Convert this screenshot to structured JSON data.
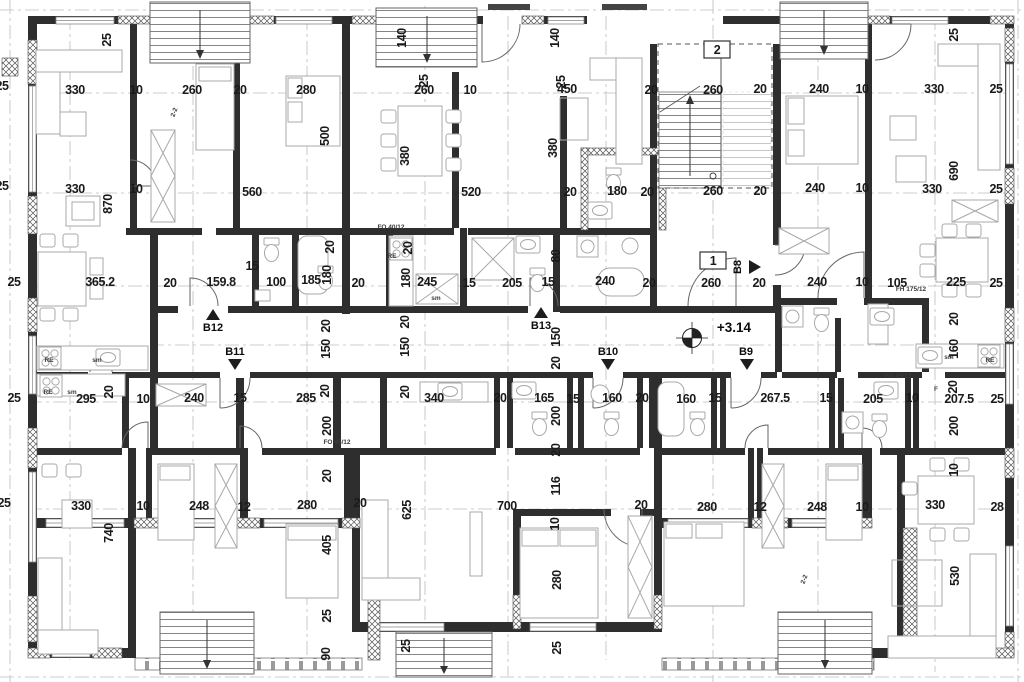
{
  "colors": {
    "wall": "#2e2e2e",
    "text": "#1a1a1a",
    "axis": "#bdbdbd",
    "furniture": "#a8a8a8",
    "stair": "#777777"
  },
  "level_annotation": {
    "t": "+3.14",
    "x": 734,
    "y": 332
  },
  "floor_numbers": [
    {
      "t": "1",
      "x": 713,
      "y": 264
    },
    {
      "t": "2",
      "x": 717,
      "y": 53
    }
  ],
  "unit_markers": [
    {
      "t": "B12",
      "x": 213,
      "y": 331,
      "dir": "up",
      "ax": 213,
      "ay": 315
    },
    {
      "t": "B11",
      "x": 235,
      "y": 355,
      "dir": "down",
      "ax": 235,
      "ay": 364
    },
    {
      "t": "B13",
      "x": 541,
      "y": 329,
      "dir": "up",
      "ax": 541,
      "ay": 313
    },
    {
      "t": "B10",
      "x": 608,
      "y": 355,
      "dir": "down",
      "ax": 608,
      "ay": 364
    },
    {
      "t": "B9",
      "x": 746,
      "y": 355,
      "dir": "down",
      "ax": 747,
      "ay": 364
    },
    {
      "t": "B8",
      "x": 741,
      "y": 267,
      "r": -90,
      "dir": "right",
      "ax": 753,
      "ay": 267
    }
  ],
  "dim_labels": [
    {
      "t": "25",
      "x": 2,
      "y": 90
    },
    {
      "t": "25",
      "x": 2,
      "y": 190
    },
    {
      "t": "330",
      "x": 75,
      "y": 94
    },
    {
      "t": "10",
      "x": 136,
      "y": 94
    },
    {
      "t": "260",
      "x": 192,
      "y": 94
    },
    {
      "t": "20",
      "x": 240,
      "y": 94
    },
    {
      "t": "280",
      "x": 306,
      "y": 94
    },
    {
      "t": "25",
      "x": 111,
      "y": 40,
      "r": -90
    },
    {
      "t": "140",
      "x": 406,
      "y": 38,
      "r": -90
    },
    {
      "t": "25",
      "x": 428,
      "y": 81,
      "r": -90
    },
    {
      "t": "260",
      "x": 424,
      "y": 94
    },
    {
      "t": "10",
      "x": 470,
      "y": 94
    },
    {
      "t": "140",
      "x": 559,
      "y": 38,
      "r": -90
    },
    {
      "t": "25",
      "x": 565,
      "y": 82,
      "r": -90
    },
    {
      "t": "450",
      "x": 567,
      "y": 93
    },
    {
      "t": "20",
      "x": 651,
      "y": 94
    },
    {
      "t": "260",
      "x": 713,
      "y": 94
    },
    {
      "t": "20",
      "x": 760,
      "y": 93
    },
    {
      "t": "240",
      "x": 819,
      "y": 93
    },
    {
      "t": "10",
      "x": 862,
      "y": 93
    },
    {
      "t": "330",
      "x": 934,
      "y": 93
    },
    {
      "t": "25",
      "x": 996,
      "y": 93
    },
    {
      "t": "25",
      "x": 958,
      "y": 35,
      "r": -90
    },
    {
      "t": "330",
      "x": 75,
      "y": 193
    },
    {
      "t": "10",
      "x": 136,
      "y": 193
    },
    {
      "t": "560",
      "x": 252,
      "y": 196
    },
    {
      "t": "870",
      "x": 112,
      "y": 204,
      "r": -90
    },
    {
      "t": "500",
      "x": 329,
      "y": 136,
      "r": -90
    },
    {
      "t": "380",
      "x": 409,
      "y": 156,
      "r": -90
    },
    {
      "t": "380",
      "x": 557,
      "y": 148,
      "r": -90
    },
    {
      "t": "520",
      "x": 471,
      "y": 196
    },
    {
      "t": "20",
      "x": 570,
      "y": 196
    },
    {
      "t": "180",
      "x": 617,
      "y": 195
    },
    {
      "t": "20",
      "x": 647,
      "y": 196
    },
    {
      "t": "260",
      "x": 713,
      "y": 195
    },
    {
      "t": "20",
      "x": 760,
      "y": 195
    },
    {
      "t": "240",
      "x": 815,
      "y": 192
    },
    {
      "t": "10",
      "x": 862,
      "y": 192
    },
    {
      "t": "330",
      "x": 932,
      "y": 193
    },
    {
      "t": "25",
      "x": 996,
      "y": 193
    },
    {
      "t": "690",
      "x": 958,
      "y": 171,
      "r": -90
    },
    {
      "t": "25",
      "x": 14,
      "y": 286
    },
    {
      "t": "365.2",
      "x": 100,
      "y": 286
    },
    {
      "t": "20",
      "x": 170,
      "y": 287
    },
    {
      "t": "159.8",
      "x": 221,
      "y": 286
    },
    {
      "t": "15",
      "x": 252,
      "y": 270
    },
    {
      "t": "100",
      "x": 276,
      "y": 286
    },
    {
      "t": "185",
      "x": 311,
      "y": 284
    },
    {
      "t": "20",
      "x": 334,
      "y": 247,
      "r": -90
    },
    {
      "t": "180",
      "x": 331,
      "y": 275,
      "r": -90
    },
    {
      "t": "20",
      "x": 358,
      "y": 287
    },
    {
      "t": "20",
      "x": 412,
      "y": 248,
      "r": -90
    },
    {
      "t": "180",
      "x": 410,
      "y": 278,
      "r": -90
    },
    {
      "t": "245",
      "x": 427,
      "y": 286
    },
    {
      "t": "15",
      "x": 469,
      "y": 287
    },
    {
      "t": "205",
      "x": 512,
      "y": 287
    },
    {
      "t": "15",
      "x": 548,
      "y": 286
    },
    {
      "t": "80",
      "x": 560,
      "y": 256,
      "r": -90
    },
    {
      "t": "240",
      "x": 605,
      "y": 285
    },
    {
      "t": "20",
      "x": 649,
      "y": 287
    },
    {
      "t": "260",
      "x": 711,
      "y": 287
    },
    {
      "t": "20",
      "x": 759,
      "y": 287
    },
    {
      "t": "240",
      "x": 817,
      "y": 286
    },
    {
      "t": "10",
      "x": 862,
      "y": 286
    },
    {
      "t": "105",
      "x": 897,
      "y": 287
    },
    {
      "t": "225",
      "x": 956,
      "y": 286
    },
    {
      "t": "25",
      "x": 996,
      "y": 287
    },
    {
      "t": "20",
      "x": 958,
      "y": 319,
      "r": -90
    },
    {
      "t": "160",
      "x": 958,
      "y": 349,
      "r": -90
    },
    {
      "t": "20",
      "x": 330,
      "y": 326,
      "r": -90
    },
    {
      "t": "150",
      "x": 330,
      "y": 349,
      "r": -90
    },
    {
      "t": "20",
      "x": 329,
      "y": 391,
      "r": -90
    },
    {
      "t": "20",
      "x": 409,
      "y": 322,
      "r": -90
    },
    {
      "t": "150",
      "x": 409,
      "y": 347,
      "r": -90
    },
    {
      "t": "20",
      "x": 409,
      "y": 392,
      "r": -90
    },
    {
      "t": "150",
      "x": 560,
      "y": 337,
      "r": -90
    },
    {
      "t": "20",
      "x": 560,
      "y": 363,
      "r": -90
    },
    {
      "t": "25",
      "x": 14,
      "y": 402
    },
    {
      "t": "295",
      "x": 86,
      "y": 403
    },
    {
      "t": "20",
      "x": 113,
      "y": 392,
      "r": -90
    },
    {
      "t": "10",
      "x": 143,
      "y": 403
    },
    {
      "t": "240",
      "x": 194,
      "y": 402
    },
    {
      "t": "15",
      "x": 240,
      "y": 402
    },
    {
      "t": "285",
      "x": 306,
      "y": 402
    },
    {
      "t": "200",
      "x": 331,
      "y": 426,
      "r": -90
    },
    {
      "t": "340",
      "x": 434,
      "y": 402
    },
    {
      "t": "20",
      "x": 500,
      "y": 402
    },
    {
      "t": "165",
      "x": 544,
      "y": 402
    },
    {
      "t": "15",
      "x": 573,
      "y": 403
    },
    {
      "t": "160",
      "x": 612,
      "y": 402
    },
    {
      "t": "20",
      "x": 642,
      "y": 402
    },
    {
      "t": "200",
      "x": 560,
      "y": 416,
      "r": -90
    },
    {
      "t": "20",
      "x": 560,
      "y": 450,
      "r": -90
    },
    {
      "t": "160",
      "x": 686,
      "y": 403
    },
    {
      "t": "15",
      "x": 715,
      "y": 402
    },
    {
      "t": "267.5",
      "x": 775,
      "y": 402
    },
    {
      "t": "15",
      "x": 826,
      "y": 402
    },
    {
      "t": "205",
      "x": 873,
      "y": 403
    },
    {
      "t": "10",
      "x": 912,
      "y": 402
    },
    {
      "t": "207.5",
      "x": 959,
      "y": 403
    },
    {
      "t": "25",
      "x": 997,
      "y": 403
    },
    {
      "t": "200",
      "x": 958,
      "y": 426,
      "r": -90
    },
    {
      "t": "20",
      "x": 957,
      "y": 387,
      "r": -90
    },
    {
      "t": "25",
      "x": 4,
      "y": 507
    },
    {
      "t": "330",
      "x": 81,
      "y": 510
    },
    {
      "t": "10",
      "x": 143,
      "y": 510
    },
    {
      "t": "248",
      "x": 199,
      "y": 510
    },
    {
      "t": "12",
      "x": 244,
      "y": 511
    },
    {
      "t": "280",
      "x": 307,
      "y": 509
    },
    {
      "t": "740",
      "x": 113,
      "y": 533,
      "r": -90
    },
    {
      "t": "20",
      "x": 331,
      "y": 476,
      "r": -90
    },
    {
      "t": "405",
      "x": 331,
      "y": 545,
      "r": -90
    },
    {
      "t": "25",
      "x": 331,
      "y": 616,
      "r": -90
    },
    {
      "t": "90",
      "x": 330,
      "y": 654,
      "r": -90
    },
    {
      "t": "20",
      "x": 360,
      "y": 507
    },
    {
      "t": "625",
      "x": 411,
      "y": 510,
      "r": -90
    },
    {
      "t": "700",
      "x": 507,
      "y": 510
    },
    {
      "t": "116",
      "x": 560,
      "y": 486,
      "r": -90
    },
    {
      "t": "10",
      "x": 559,
      "y": 524,
      "r": -90
    },
    {
      "t": "280",
      "x": 561,
      "y": 580,
      "r": -90
    },
    {
      "t": "20",
      "x": 641,
      "y": 509
    },
    {
      "t": "25",
      "x": 410,
      "y": 646,
      "r": -90
    },
    {
      "t": "25",
      "x": 561,
      "y": 648,
      "r": -90
    },
    {
      "t": "280",
      "x": 707,
      "y": 511
    },
    {
      "t": "12",
      "x": 760,
      "y": 511
    },
    {
      "t": "248",
      "x": 817,
      "y": 511
    },
    {
      "t": "10",
      "x": 862,
      "y": 511
    },
    {
      "t": "330",
      "x": 935,
      "y": 509
    },
    {
      "t": "28",
      "x": 997,
      "y": 511
    },
    {
      "t": "10",
      "x": 958,
      "y": 470,
      "r": -90
    },
    {
      "t": "530",
      "x": 959,
      "y": 576,
      "r": -90
    }
  ],
  "small_labels": [
    {
      "t": "RE",
      "x": 49,
      "y": 362
    },
    {
      "t": "sm",
      "x": 97,
      "y": 362
    },
    {
      "t": "RE",
      "x": 48,
      "y": 394
    },
    {
      "t": "sm",
      "x": 72,
      "y": 394
    },
    {
      "t": "RE",
      "x": 392,
      "y": 258
    },
    {
      "t": "sm",
      "x": 436,
      "y": 300
    },
    {
      "t": "sm",
      "x": 949,
      "y": 359
    },
    {
      "t": "RE",
      "x": 990,
      "y": 362
    },
    {
      "t": "F",
      "x": 936,
      "y": 391
    },
    {
      "t": "FO 45/12",
      "x": 337,
      "y": 444
    },
    {
      "t": "FO 45/12",
      "x": 898,
      "y": 378
    },
    {
      "t": "FH 175/12",
      "x": 911,
      "y": 291
    },
    {
      "t": "FO 40/12",
      "x": 391,
      "y": 229
    },
    {
      "t": "2-2",
      "x": 176,
      "y": 113,
      "r": -70
    },
    {
      "t": "2-2",
      "x": 806,
      "y": 580,
      "r": -70
    }
  ]
}
